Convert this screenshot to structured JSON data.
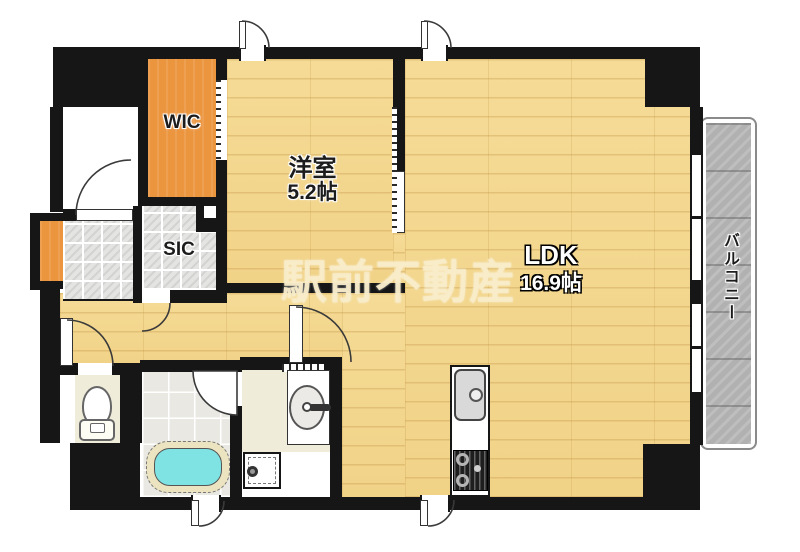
{
  "floorplan": {
    "watermark_text": "駅前不動産",
    "rooms": {
      "western_room": {
        "name": "洋室",
        "size": "5.2帖"
      },
      "ldk": {
        "name": "LDK",
        "size": "16.9帖"
      },
      "wic": {
        "name": "WIC"
      },
      "sic": {
        "name": "SIC"
      },
      "balcony": {
        "name": "バルコニー"
      }
    },
    "colors": {
      "wall": "#161616",
      "wood_floor": "#f3d78f",
      "closet_orange": "#eb953f",
      "tile_gray": "#e4e4e2",
      "bath_water_cyan": "#7fe3e4",
      "balcony_gray": "#b3b3b3",
      "cream_floor": "#f0ecda",
      "watermark_cream": "#f8ecc8"
    }
  }
}
